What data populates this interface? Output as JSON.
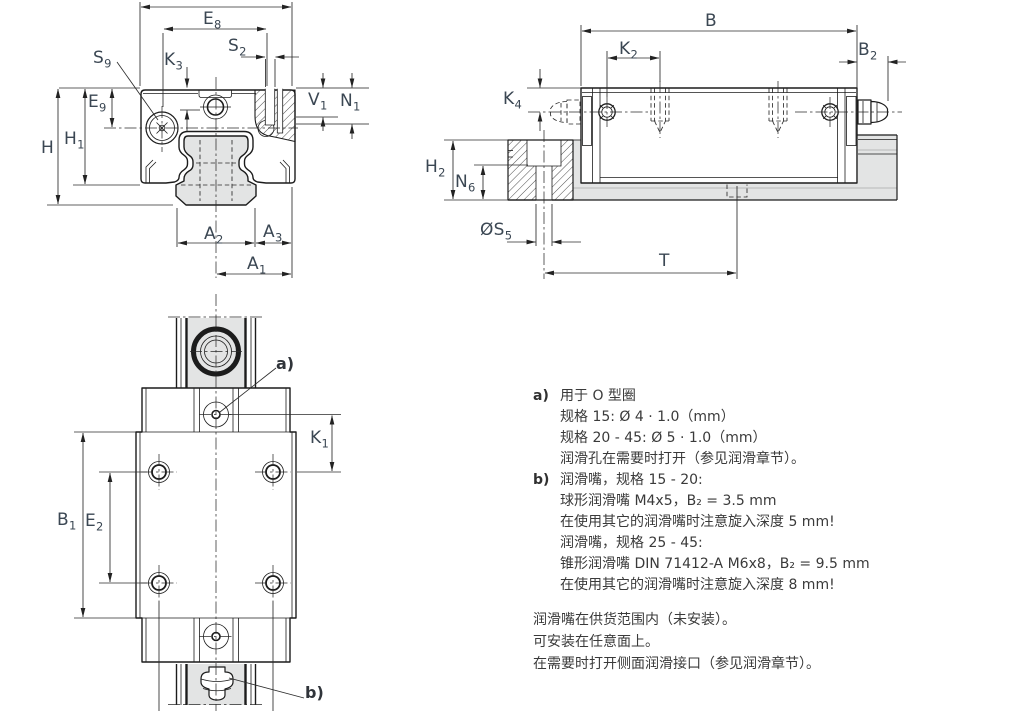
{
  "drawing_labels": {
    "cross_section": {
      "e8": {
        "base": "E",
        "sub": "8"
      },
      "s2": {
        "base": "S",
        "sub": "2"
      },
      "s9": {
        "base": "S",
        "sub": "9"
      },
      "k3": {
        "base": "K",
        "sub": "3"
      },
      "v1": {
        "base": "V",
        "sub": "1"
      },
      "n1": {
        "base": "N",
        "sub": "1"
      },
      "e9": {
        "base": "E",
        "sub": "9"
      },
      "h1": {
        "base": "H",
        "sub": "1"
      },
      "h": {
        "base": "H",
        "sub": ""
      },
      "a2": {
        "base": "A",
        "sub": "2"
      },
      "a3": {
        "base": "A",
        "sub": "3"
      },
      "a1": {
        "base": "A",
        "sub": "1"
      }
    },
    "side": {
      "b": {
        "base": "B",
        "sub": ""
      },
      "k2": {
        "base": "K",
        "sub": "2"
      },
      "b2": {
        "base": "B",
        "sub": "2"
      },
      "k4": {
        "base": "K",
        "sub": "4"
      },
      "h2": {
        "base": "H",
        "sub": "2"
      },
      "n6": {
        "base": "N",
        "sub": "6"
      },
      "s5": {
        "base": "ØS",
        "sub": "5"
      },
      "t": {
        "base": "T",
        "sub": ""
      }
    },
    "plan": {
      "k1": {
        "base": "K",
        "sub": "1"
      },
      "b1": {
        "base": "B",
        "sub": "1"
      },
      "e2": {
        "base": "E",
        "sub": "2"
      },
      "a_marker": "a)",
      "b_marker": "b)"
    }
  },
  "notes": {
    "items": [
      {
        "marker": "a)",
        "lines": [
          "用于 O 型圈",
          "规格 15: Ø 4 · 1.0（mm）",
          "规格 20 - 45: Ø 5 · 1.0（mm）",
          "润滑孔在需要时打开（参见润滑章节）。"
        ]
      },
      {
        "marker": "b)",
        "lines": [
          "润滑嘴，规格 15 - 20:",
          "球形润滑嘴 M4x5，B₂ = 3.5 mm",
          "在使用其它的润滑嘴时注意旋入深度 5 mm!",
          "润滑嘴，规格 25 - 45:",
          "锥形润滑嘴 DIN 71412-A M6x8，B₂ = 9.5 mm",
          "在使用其它的润滑嘴时注意旋入深度 8 mm!"
        ]
      }
    ],
    "footer": [
      "润滑嘴在供货范围内（未安装）。",
      "可安装在任意面上。",
      "在需要时打开侧面润滑接口（参见润滑章节）。"
    ]
  }
}
